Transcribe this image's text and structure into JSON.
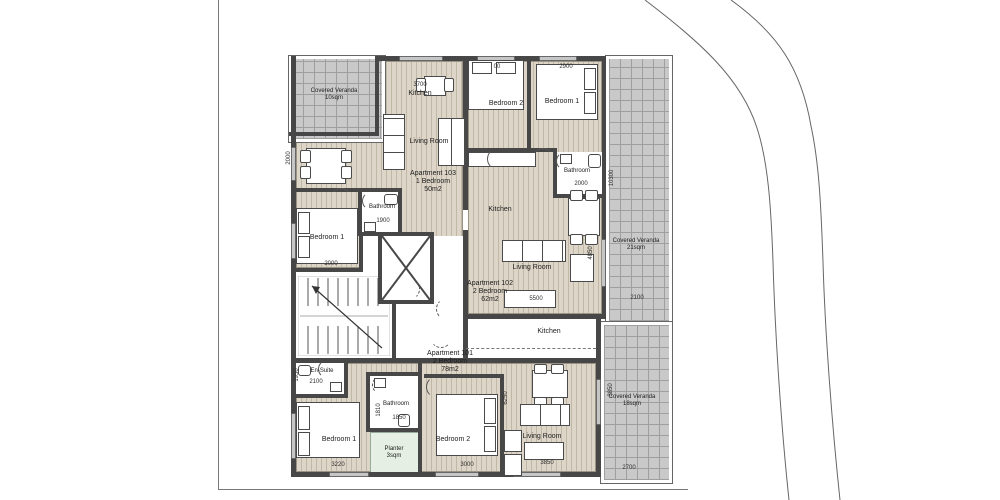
{
  "plan": {
    "verandas": {
      "top_left": {
        "line1": "Covered Veranda",
        "line2": "10sqm"
      },
      "right": {
        "line1": "Covered Veranda",
        "line2": "21sqm"
      },
      "bottom_right": {
        "line1": "Covered Veranda",
        "line2": "18sqm"
      }
    },
    "apartments": {
      "a103": {
        "line1": "Apartment 103",
        "line2": "1 Bedroom",
        "line3": "50m2"
      },
      "a102": {
        "line1": "Apartment 102",
        "line2": "2 Bedroom",
        "line3": "62m2"
      },
      "a101": {
        "line1": "Apartment 101",
        "line2": "2 Bedroom",
        "line3": "78m2"
      }
    },
    "rooms": {
      "kitchen_103": "Kitchen",
      "living_103": "Living Room",
      "bedroom1_103": "Bedroom 1",
      "bathroom_103": "Bathroom",
      "bedroom2_102": "Bedroom 2",
      "bedroom1_102": "Bedroom 1",
      "bathroom_102": "Bathroom",
      "kitchen_102": "Kitchen",
      "living_102": "Living Room",
      "ensuite_101": "En-Suite",
      "bedroom1_101": "Bedroom 1",
      "bathroom_101": "Bathroom",
      "bedroom2_101": "Bedroom 2",
      "kitchen_101": "Kitchen",
      "living_101": "Living Room",
      "planter": {
        "line1": "Planter",
        "line2": "3sqm"
      }
    },
    "dimensions": {
      "kitchen_103_width": "3700",
      "bedroom2_102_width": "00",
      "bedroom1_102_width": "2900",
      "dining_103_height": "2000",
      "bedroom1_103_width": "2000",
      "bathroom_103_width": "1900",
      "bathroom_102_width": "2000",
      "veranda_right_height": "10300",
      "living_102_height": "4850",
      "living_102_width": "5500",
      "veranda_right_width": "2100",
      "ensuite_width": "2100",
      "ensuite_height": "1950",
      "bathroom_101_height": "1810",
      "bathroom_101_width": "1850",
      "bedroom1_101_width": "3220",
      "bedroom2_101_width": "3000",
      "living_101_height": "6250",
      "living_101_width": "3850",
      "veranda_br_height": "3850",
      "veranda_br_width": "2700"
    },
    "colors": {
      "wall": "#474747",
      "floor": "#ddd5c8",
      "veranda": "#c9c9c9",
      "planter": "#e5efe3"
    }
  }
}
